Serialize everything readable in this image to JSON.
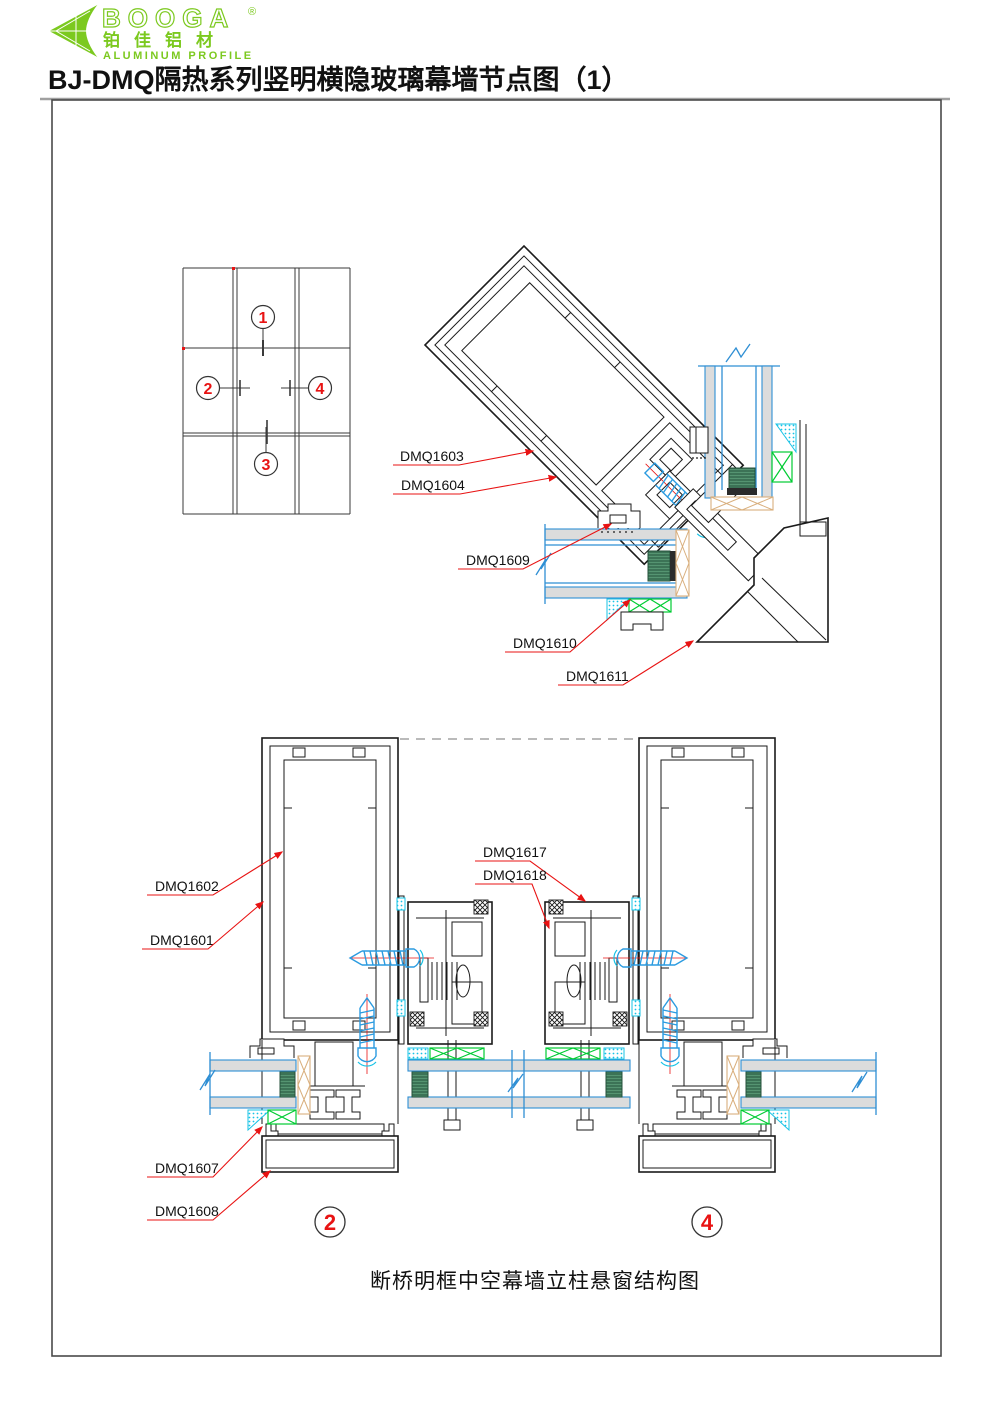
{
  "logo": {
    "brand": "BOOGA",
    "registered": "®",
    "chinese": "铂佳铝材",
    "tagline": "ALUMINUM PROFILE"
  },
  "title": "BJ-DMQ隔热系列竖明横隐玻璃幕墙节点图（1）",
  "key_plan": {
    "callout_1": "1",
    "callout_2": "2",
    "callout_3": "3",
    "callout_4": "4"
  },
  "labels": {
    "dmq1601": "DMQ1601",
    "dmq1602": "DMQ1602",
    "dmq1603": "DMQ1603",
    "dmq1604": "DMQ1604",
    "dmq1607": "DMQ1607",
    "dmq1608": "DMQ1608",
    "dmq1609": "DMQ1609",
    "dmq1610": "DMQ1610",
    "dmq1611": "DMQ1611",
    "dmq1617": "DMQ1617",
    "dmq1618": "DMQ1618"
  },
  "section_markers": {
    "left": "2",
    "right": "4"
  },
  "caption": "断桥明框中空幕墙立柱悬窗结构图",
  "colors": {
    "brand_green": "#7cc91f",
    "line_black": "#1a1a1a",
    "leader_red": "#e81313",
    "glass_blue": "#2f8fd4",
    "screw_blue": "#2b9be0",
    "seal_cyan": "#17c3e6",
    "gasket_green": "#00cc33",
    "setting_block_green": "#3c7356",
    "backer_tan": "#d9af7d"
  }
}
